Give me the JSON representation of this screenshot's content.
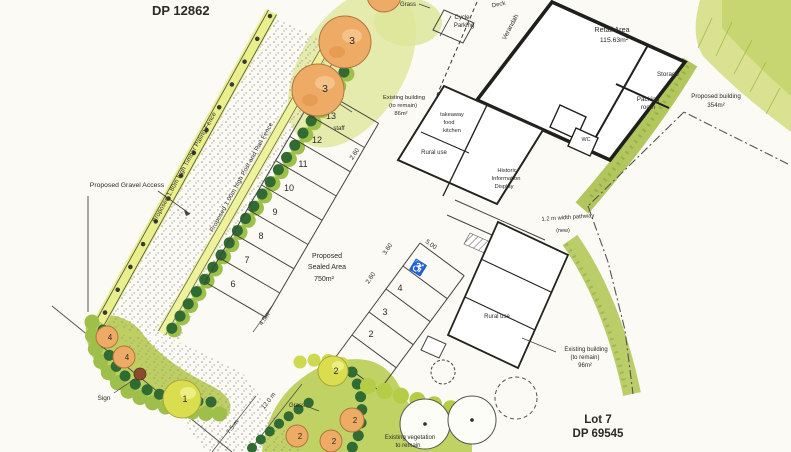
{
  "titles": {
    "dp_top": "DP 12862",
    "lot_bottom": "Lot 7",
    "dp_bottom": "DP 69545"
  },
  "fences": {
    "timber": "Proposed 1.80m high Timber Paling Fence",
    "post_rail": "Proposed 1.00m high Post and Rail Fence"
  },
  "access": {
    "gravel": "Proposed Gravel Access",
    "sealed_line1": "Proposed",
    "sealed_line2": "Sealed Area",
    "sealed_line3": "750m²",
    "pathway": "1.2 m width pathway",
    "pathway_note": "(new)"
  },
  "buildings": {
    "retail": {
      "name": "Retail Area",
      "area": "115.63m²",
      "storage": "Storage",
      "packing_line1": "Packing",
      "packing_line2": "room",
      "wc": "WC"
    },
    "existing_top": {
      "line1": "Existing building",
      "line2": "(to remain)",
      "line3": "86m²",
      "takeaway_line1": "takeaway",
      "takeaway_line2": "food",
      "takeaway_line3": "kitchen",
      "rural": "Rural use",
      "historic_line1": "Historic",
      "historic_line2": "Information",
      "historic_line3": "Display"
    },
    "proposed": {
      "line1": "Proposed building",
      "line2": "354m²"
    },
    "existing_bottom": {
      "line1": "Existing building",
      "line2": "(to remain)",
      "line3": "96m²",
      "rural": "Rural use"
    },
    "cycle_line1": "Cycle",
    "cycle_line2": "Parking",
    "verandah": "Verandah",
    "deck": "Deck"
  },
  "parking": {
    "left": [
      "13",
      "12",
      "11",
      "10",
      "9",
      "8",
      "7",
      "6"
    ],
    "right": [
      "4",
      "3",
      "2"
    ],
    "staff": "staff",
    "disabled_symbol": "♿"
  },
  "dimensions": {
    "d500_left": "5.00",
    "d260_left": "2.60",
    "d360": "3.60",
    "d260_right": "2.60",
    "d500_right": "5.00",
    "d12": "12.0 m",
    "d75": "7.5 m",
    "d45": "4.5m"
  },
  "landscape": {
    "grass_top": "Grass",
    "grass_bottom": "Grass",
    "veg_line1": "Existing vegetation",
    "veg_line2": "to remain",
    "sign": "Sign",
    "t1": "1",
    "t2": "2",
    "t3": "3",
    "t4": "4"
  },
  "colors": {
    "paper": "#fbfaf4",
    "ink": "#2a2a26",
    "fence_yellow": "#e9ef8a",
    "leaf_dark": "#2f6b33",
    "leaf_light": "#9ebf4a",
    "bed_green": "#bccf60",
    "hedge_green": "#a8c04d",
    "wash_green": "#dce697",
    "tree_orange": "#eeab66",
    "tree_yellow": "#d9dd4e"
  }
}
